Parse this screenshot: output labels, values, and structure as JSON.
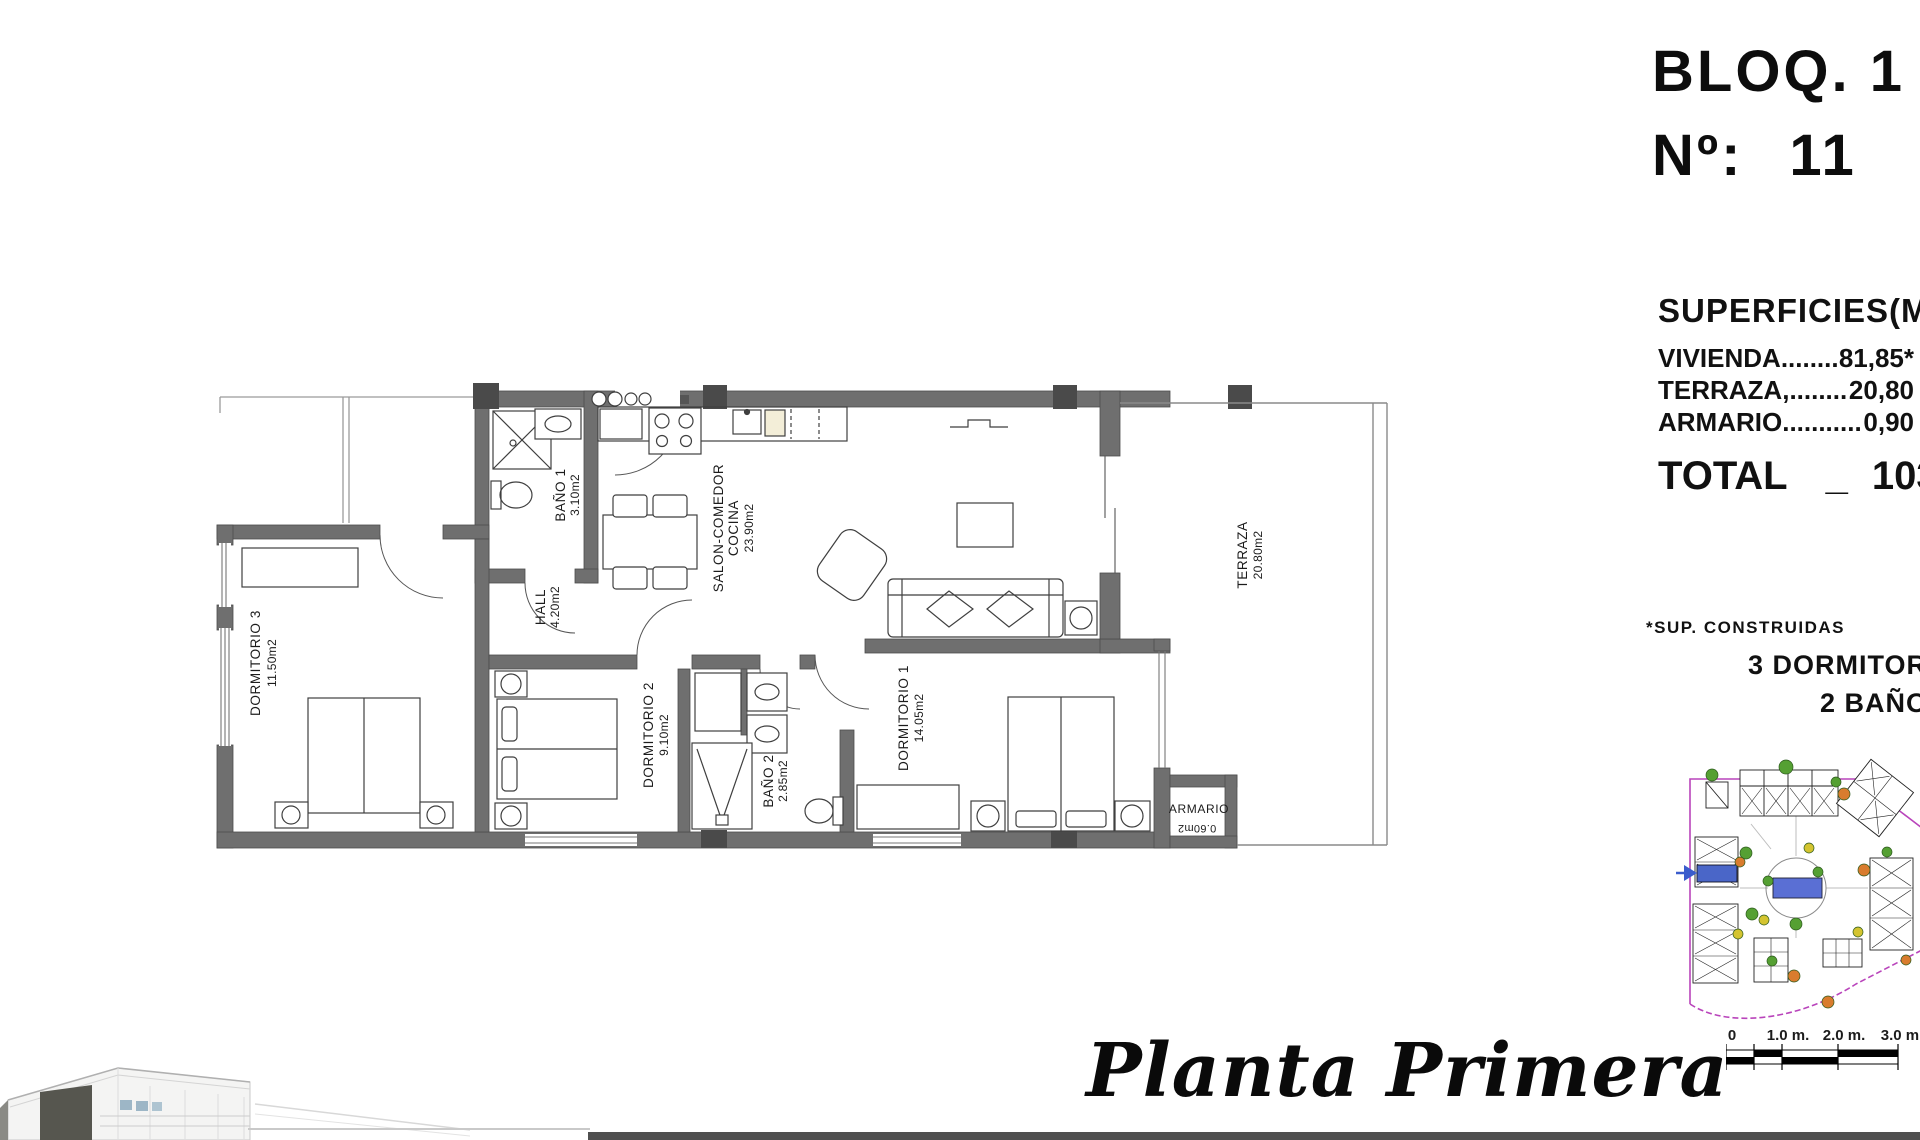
{
  "header": {
    "bloq": "BLOQ. 1",
    "no_label": "Nº:",
    "no_value": "11"
  },
  "superficies": {
    "title": "SUPERFICIES(M2)",
    "rows": [
      {
        "label": "VIVIENDA",
        "dots": "....................",
        "value": "81,85*"
      },
      {
        "label": "TERRAZA,",
        "dots": "....................",
        "value": "20,80"
      },
      {
        "label": "ARMARIO",
        "dots": "....................",
        "value": "0,90"
      }
    ],
    "total_label": "TOTAL",
    "total_dash": "_",
    "total_value": "103,55",
    "note": "*SUP. CONSTRUIDAS",
    "bedrooms": "3 DORMITORIOS",
    "bathrooms": "2 BAÑOS"
  },
  "rooms": {
    "dormitorio3": {
      "name": "DORMITORIO 3",
      "area": "11.50m2"
    },
    "bano1": {
      "name": "BAÑO 1",
      "area": "3.10m2"
    },
    "hall": {
      "name": "HALL",
      "area": "4.20m2"
    },
    "salon": {
      "name1": "SALON-COMEDOR",
      "name2": "COCINA",
      "area": "23.90m2"
    },
    "dormitorio2": {
      "name": "DORMITORIO 2",
      "area": "9.10m2"
    },
    "bano2": {
      "name": "BAÑO 2",
      "area": "2.85m2"
    },
    "dormitorio1": {
      "name": "DORMITORIO 1",
      "area": "14.05m2"
    },
    "terraza": {
      "name": "TERRAZA",
      "area": "20.80m2"
    },
    "armario": {
      "name": "ARMARIO",
      "area": "0.60m2"
    }
  },
  "footer": {
    "floor_title": "Planta Primera"
  },
  "scalebar": {
    "labels": [
      "0",
      "1.0 m.",
      "2.0 m.",
      "3.0 m."
    ]
  },
  "colors": {
    "wall": "#6f6f6f",
    "pier": "#4a4a4a",
    "boundary": "#b944bb",
    "pool": "#5a6fd4",
    "highlight_unit": "#4a66c8",
    "tree_green": "#55a033",
    "tree_orange": "#d97c2e",
    "tree_yellow": "#d4c430"
  }
}
